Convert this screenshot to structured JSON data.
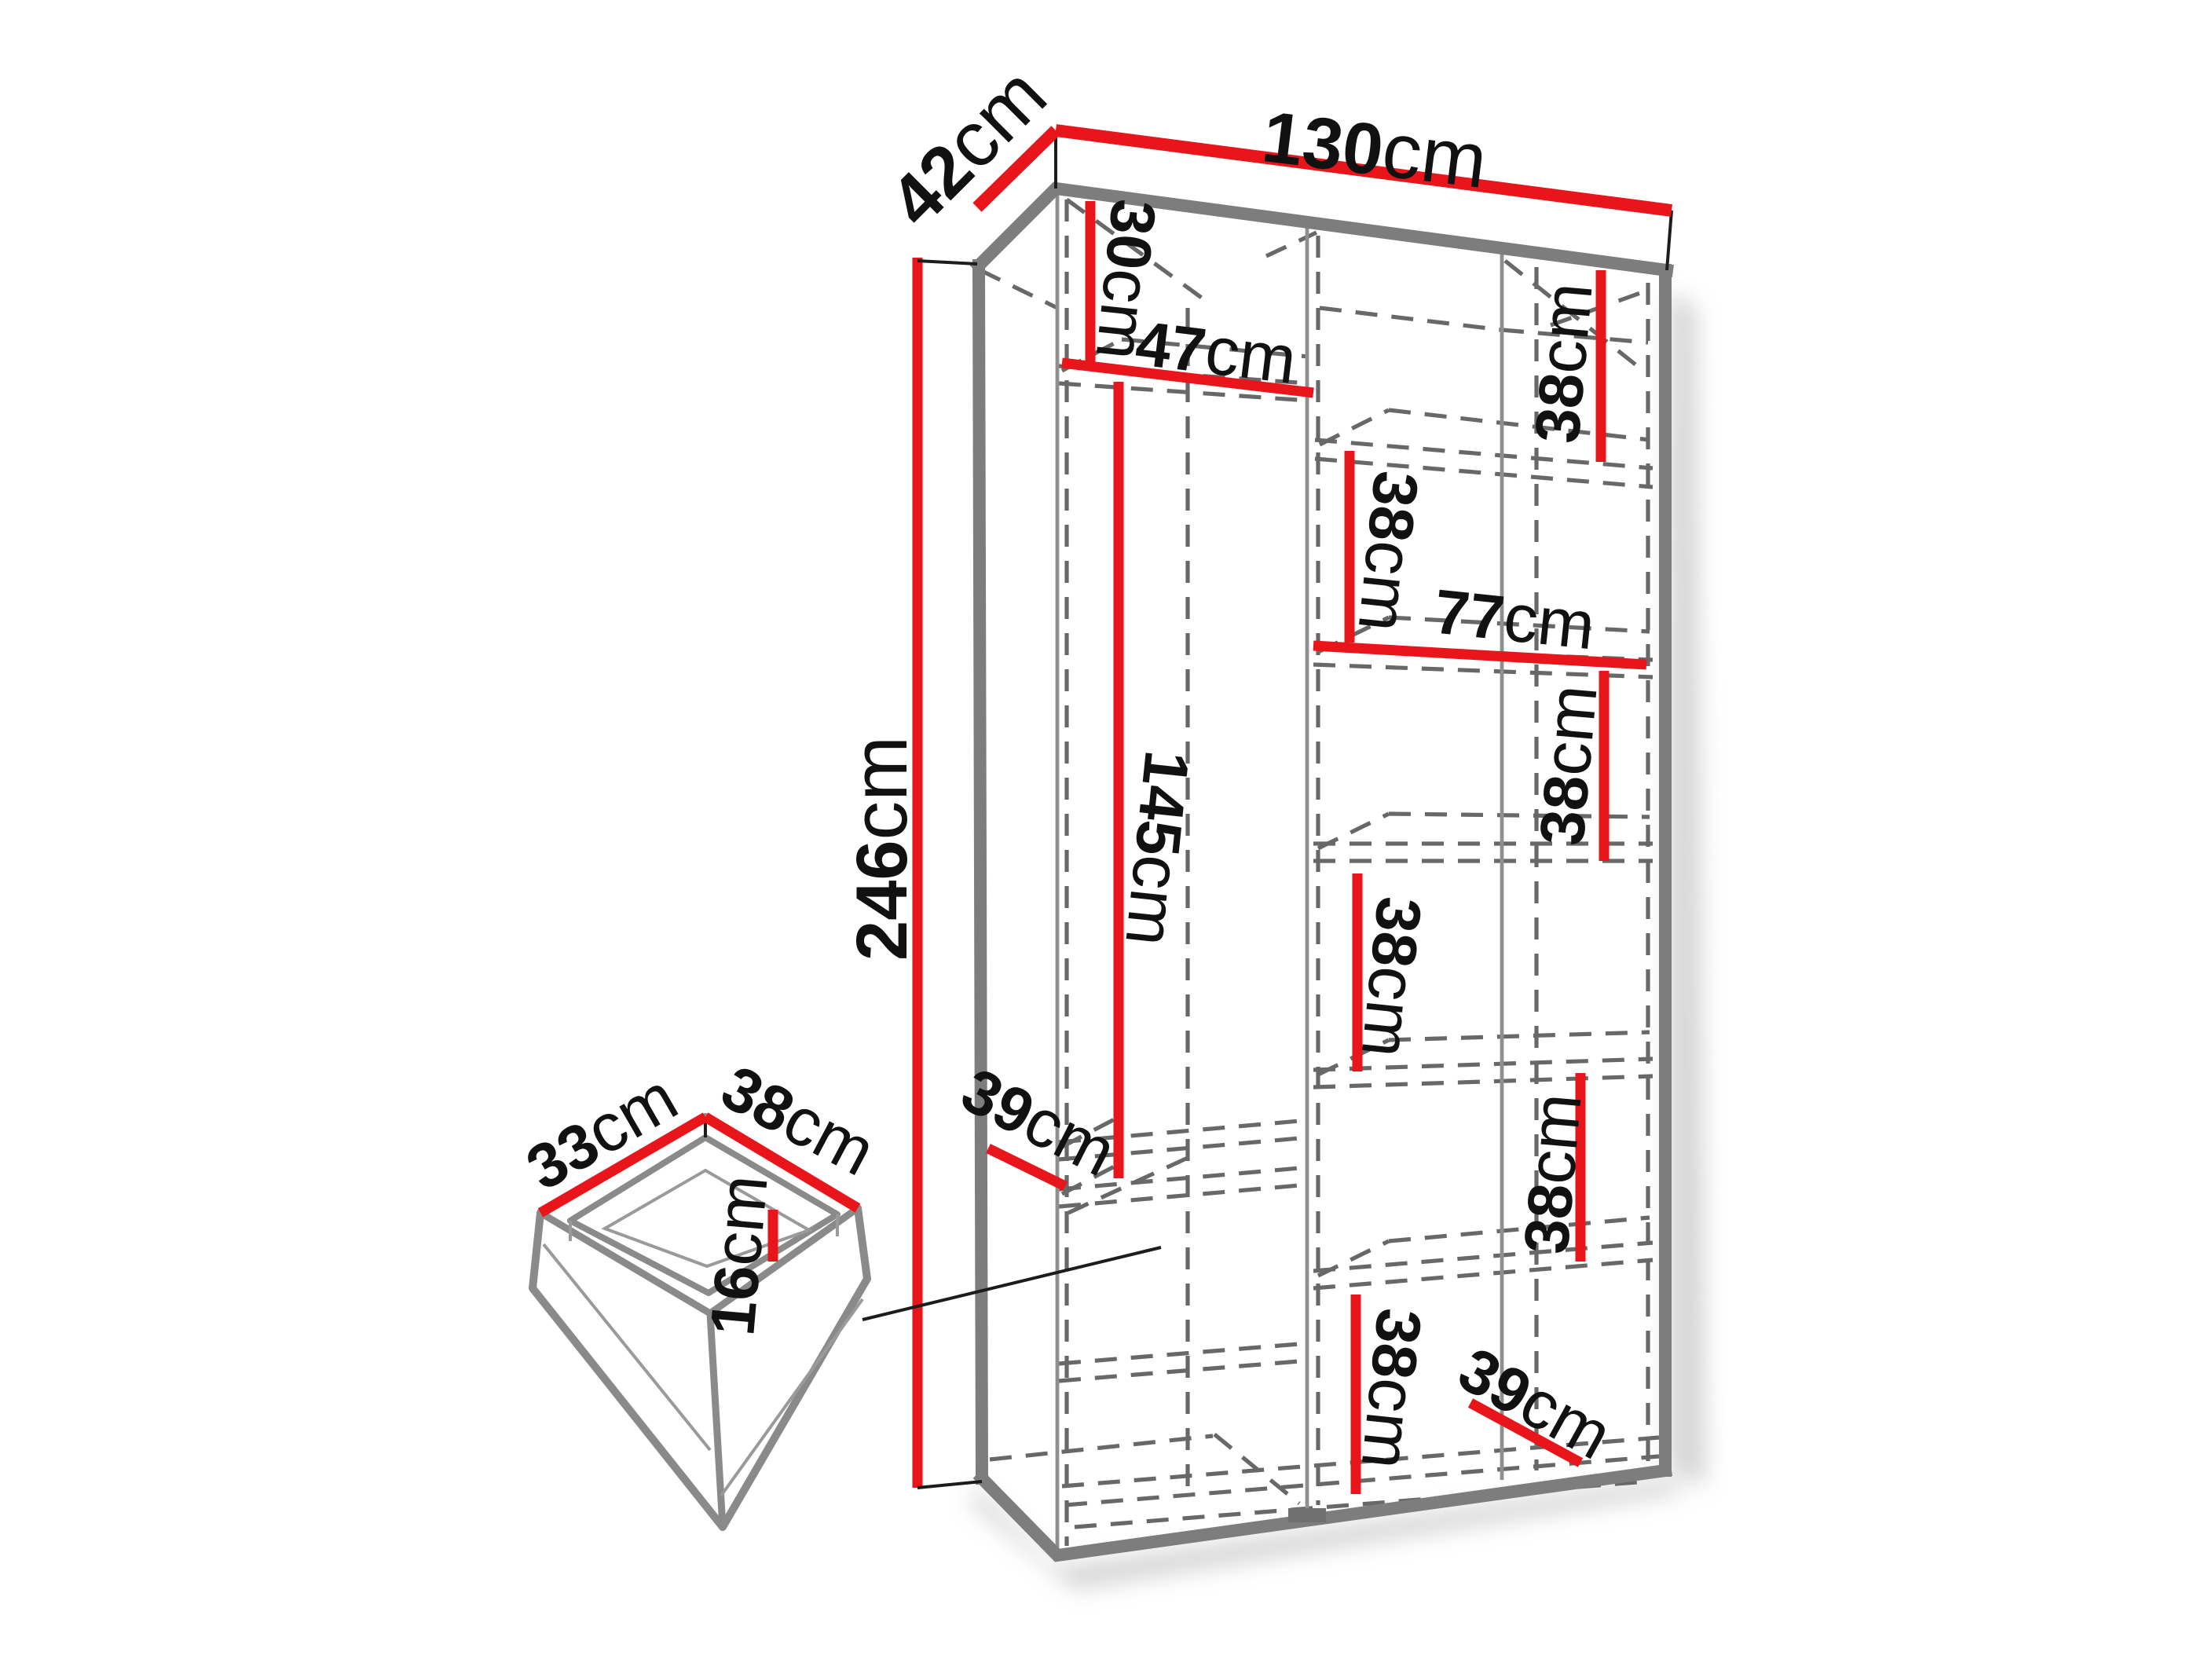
{
  "diagram": {
    "type": "furniture-dimension-diagram",
    "subject": "Wardrobe interior dimensions with pull-out drawer detail",
    "unit": "cm",
    "colors": {
      "dimension_red": "#e8151b",
      "edge_gray": "#7d7d7d",
      "dash_gray": "#686868",
      "text_black": "#111111",
      "background": "#ffffff"
    },
    "labels": {
      "width": {
        "value": "130",
        "unit": "cm"
      },
      "depth": {
        "value": "42",
        "unit": "cm"
      },
      "height": {
        "value": "246",
        "unit": "cm"
      },
      "top_shelf": {
        "value": "30",
        "unit": "cm"
      },
      "left_width": {
        "value": "47",
        "unit": "cm"
      },
      "hanging": {
        "value": "145",
        "unit": "cm"
      },
      "left_depth": {
        "value": "39",
        "unit": "cm"
      },
      "right_width": {
        "value": "77",
        "unit": "cm"
      },
      "shelf_a": {
        "value": "38",
        "unit": "cm"
      },
      "shelf_b": {
        "value": "38",
        "unit": "cm"
      },
      "shelf_c": {
        "value": "38",
        "unit": "cm"
      },
      "shelf_d": {
        "value": "38",
        "unit": "cm"
      },
      "shelf_e": {
        "value": "38",
        "unit": "cm"
      },
      "shelf_f": {
        "value": "38",
        "unit": "cm"
      },
      "bottom_depth": {
        "value": "39",
        "unit": "cm"
      },
      "drawer_depth": {
        "value": "33",
        "unit": "cm"
      },
      "drawer_width": {
        "value": "38",
        "unit": "cm"
      },
      "drawer_height": {
        "value": "16",
        "unit": "cm"
      }
    }
  }
}
